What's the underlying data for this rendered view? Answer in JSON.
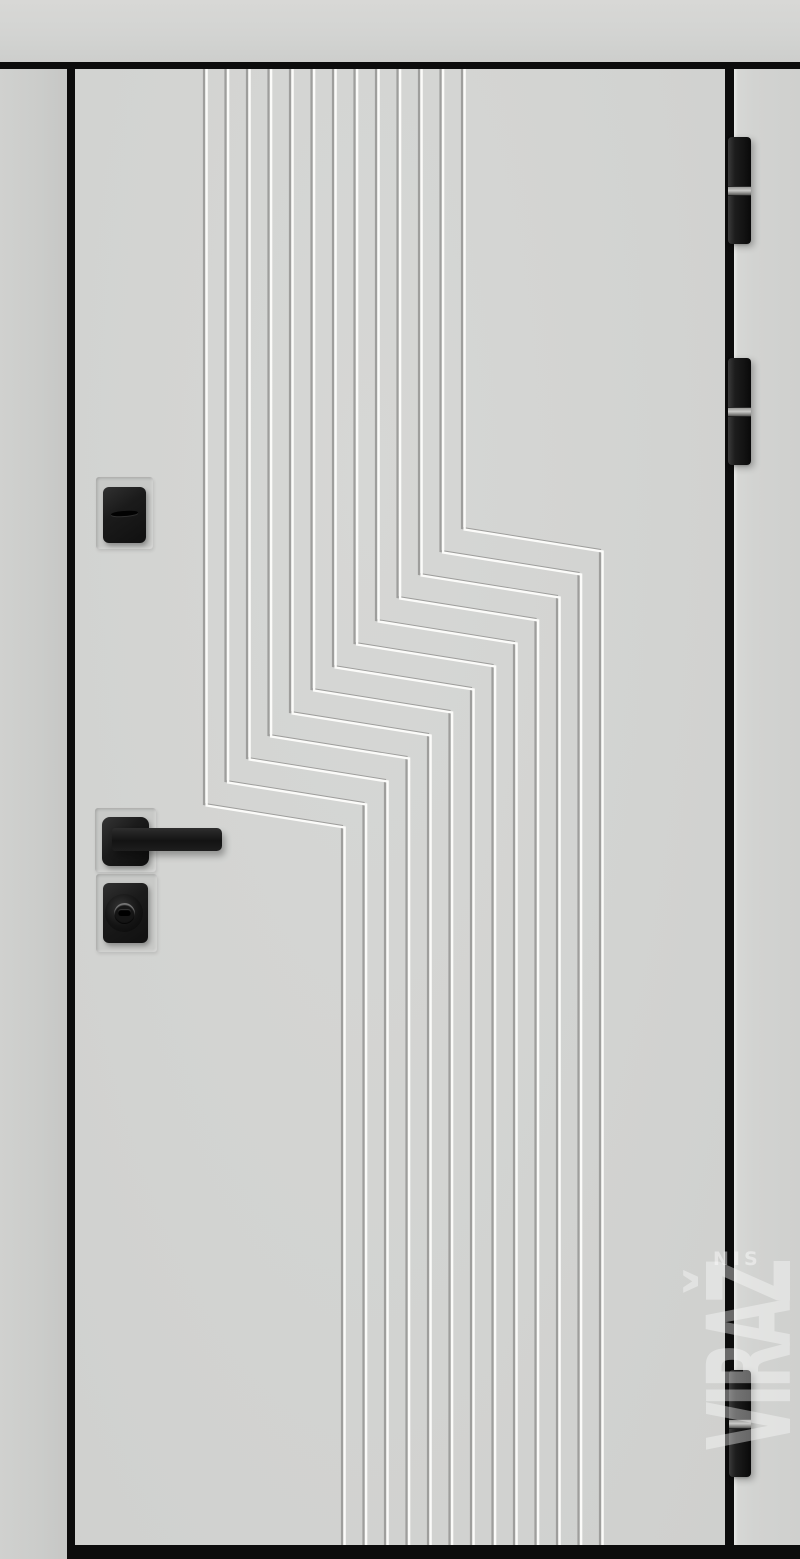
{
  "scene": {
    "type": "product-photo",
    "subject": "Light grey modern entrance door with vertical milled groove pattern offset by a zigzag step, black fittings, black frame edges",
    "canvas": {
      "width": 800,
      "height": 1559
    }
  },
  "colors": {
    "wall": "#d5d6d4",
    "door_leaf": "#d3d4d2",
    "frame_black": "#0c0c0c",
    "groove_dark": "#9e9e9c",
    "groove_light": "#fbfbf9",
    "hardware_black": "#1a1a1a",
    "hinge_band_silver": "#b5b5b3",
    "watermark_white": "#ffffff"
  },
  "frame": {
    "wall": {
      "x": 0,
      "y": 0,
      "w": 800,
      "h": 62
    },
    "top_bar": {
      "x": 0,
      "y": 62,
      "w": 800,
      "h": 7
    },
    "left_jamb": {
      "x": 0,
      "y": 69,
      "w": 67,
      "h": 1490
    },
    "left_edge": {
      "x": 67,
      "y": 62,
      "w": 8,
      "h": 1497
    },
    "leaf": {
      "x": 75,
      "y": 69,
      "w": 650,
      "h": 1476
    },
    "right_edge": {
      "x": 725,
      "y": 62,
      "w": 9,
      "h": 1483
    },
    "right_jamb": {
      "x": 734,
      "y": 69,
      "w": 66,
      "h": 1490
    },
    "bottom_bar": {
      "x": 75,
      "y": 1545,
      "w": 725,
      "h": 14
    }
  },
  "pattern": {
    "groove_count": 13,
    "top_x_start": 204,
    "pitch": 21.5,
    "top_y": 69,
    "bottom_y": 1546,
    "jog_dx": 138,
    "jog_dy": 22,
    "first_turn_y_rightmost": 528,
    "turn_y_step": 23,
    "dark_width": 2.2,
    "light_width": 2.4,
    "light_offset": 2.6
  },
  "hinges": [
    {
      "x": 728,
      "y": 137,
      "w": 23,
      "h": 107,
      "band": {
        "x": 728,
        "y": 186,
        "w": 23,
        "h": 8
      }
    },
    {
      "x": 728,
      "y": 358,
      "w": 23,
      "h": 107,
      "band": {
        "x": 728,
        "y": 407,
        "w": 23,
        "h": 8
      }
    },
    {
      "x": 729,
      "y": 1370,
      "w": 22,
      "h": 107,
      "band": {
        "x": 729,
        "y": 1419,
        "w": 22,
        "h": 8
      }
    }
  ],
  "lock_upper": {
    "plate": {
      "x": 96,
      "y": 477,
      "w": 57,
      "h": 72
    },
    "body": {
      "x": 103,
      "y": 487,
      "w": 43,
      "h": 56
    },
    "slit": {
      "x": 111,
      "y": 511,
      "w": 27,
      "h": 5
    }
  },
  "handle": {
    "plate": {
      "x": 95,
      "y": 808,
      "w": 61,
      "h": 64
    },
    "rosette": {
      "x": 102,
      "y": 817,
      "w": 47,
      "h": 49
    },
    "lever": {
      "x": 112,
      "y": 828,
      "w": 110,
      "h": 23
    }
  },
  "cylinder": {
    "plate": {
      "x": 96,
      "y": 874,
      "w": 61,
      "h": 78
    },
    "body": {
      "x": 103,
      "y": 883,
      "w": 45,
      "h": 60
    },
    "face": {
      "x": 105,
      "y": 894,
      "w": 38,
      "h": 38
    },
    "core": {
      "x": 114,
      "y": 903,
      "w": 21,
      "h": 21
    },
    "keyway": {
      "x": 118,
      "y": 909,
      "w": 13,
      "h": 7
    }
  },
  "watermark": {
    "text": "VIRAŽ",
    "small_text": "NIS",
    "big": {
      "x": 700,
      "y": 1242,
      "w": 100,
      "h": 228
    },
    "small": {
      "x": 713,
      "y": 1248,
      "w": 80,
      "h": 20
    }
  }
}
